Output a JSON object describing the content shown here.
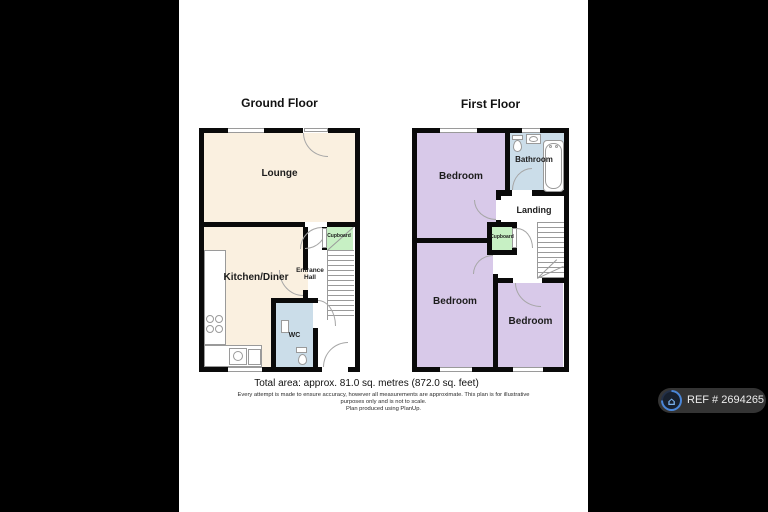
{
  "colors": {
    "letterbox": "#000000",
    "wall": "#0a0a0a",
    "room_cream": "#faf0e0",
    "room_lavender": "#d8c9e9",
    "room_blue": "#cbdde9",
    "room_green": "#c7f0c4",
    "badge_bg": "#343434",
    "badge_ring": "#4a86d8",
    "badge_house": "#7ab0ea"
  },
  "ground_floor": {
    "title": "Ground Floor",
    "rooms": {
      "lounge": "Lounge",
      "kitchen_diner": "Kitchen/Diner",
      "entrance_hall": "Entrance Hall",
      "wc": "WC",
      "cupboard": "Cupboard"
    }
  },
  "first_floor": {
    "title": "First Floor",
    "rooms": {
      "bedroom_front": "Bedroom",
      "bathroom": "Bathroom",
      "landing": "Landing",
      "cupboard": "Cupboard",
      "bedroom_rear": "Bedroom",
      "bedroom_third": "Bedroom"
    }
  },
  "footer": {
    "total_area": "Total area: approx. 81.0 sq. metres (872.0 sq. feet)",
    "disclaimer_line1": "Every attempt is made to ensure accuracy, however all measurements are approximate. This plan is for illustrative",
    "disclaimer_line2": "purposes only and is not to scale.",
    "disclaimer_line3": "Plan produced using PlanUp."
  },
  "watermark": {
    "ref": "REF # 2694265",
    "house_glyph": "⌂"
  }
}
